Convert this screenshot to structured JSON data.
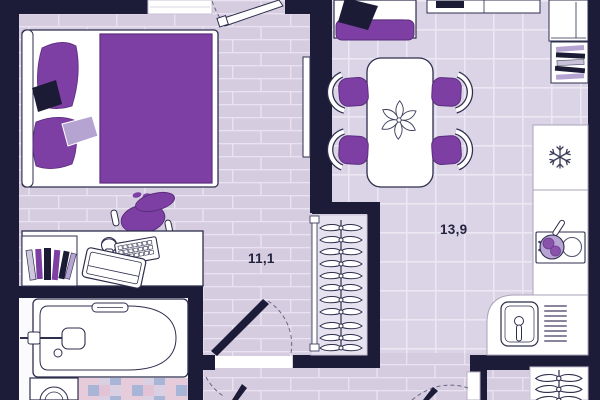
{
  "plan": {
    "title": "apartment-floor-plan",
    "rooms": [
      {
        "name": "living-sleeping-room",
        "area_label": "11,1"
      },
      {
        "name": "kitchen-dining-room",
        "area_label": "13,9"
      }
    ],
    "palette": {
      "wall": "#1c1c38",
      "plank_floor": "#d5cce0",
      "tile_floor": "#dad4e6",
      "accent_purple": "#7d3fa3",
      "accent_lavender": "#b5a3d2",
      "pillow_navy": "#1b1b36",
      "furniture_white": "#ffffff"
    },
    "furniture_icons": [
      "bed",
      "double-blanket",
      "pillows",
      "desk",
      "bookshelf-books",
      "headphones",
      "keyboard",
      "laptop",
      "desk-chair",
      "bathtub",
      "washing-machine",
      "hallway-closet-hangers",
      "sofa",
      "tv-stand",
      "dining-table",
      "plant",
      "dining-chairs",
      "wardrobe",
      "bookshelf",
      "fridge-snowflake",
      "cooktop",
      "frying-pan",
      "kitchen-sink",
      "coat-rack-hangers",
      "door-swings"
    ]
  }
}
